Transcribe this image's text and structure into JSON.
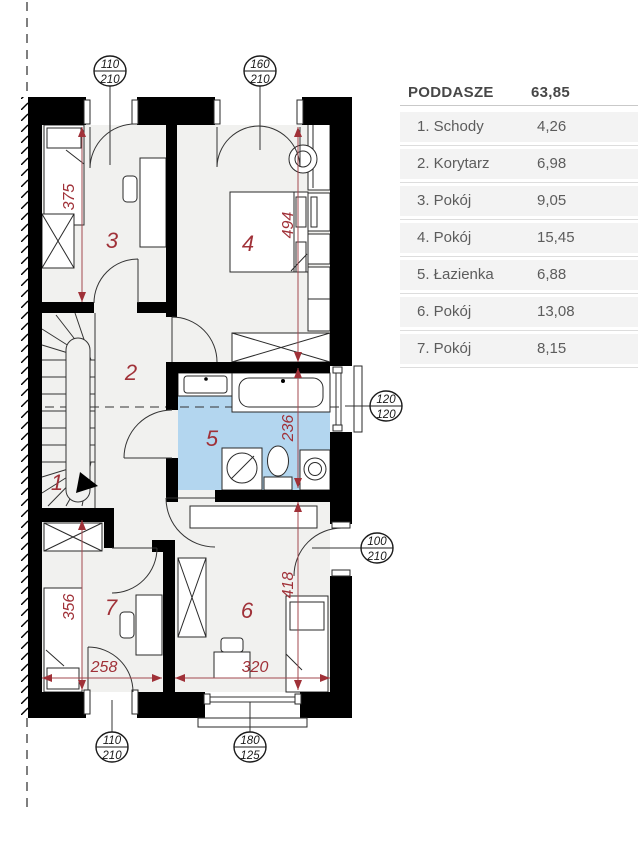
{
  "legend": {
    "title": "PODDASZE",
    "total_area": "63,85",
    "rows": [
      {
        "label": "1. Schody",
        "area": "4,26"
      },
      {
        "label": "2. Korytarz",
        "area": "6,98"
      },
      {
        "label": "3. Pokój",
        "area": "9,05"
      },
      {
        "label": "4. Pokój",
        "area": "15,45"
      },
      {
        "label": "5. Łazienka",
        "area": "6,88"
      },
      {
        "label": "6. Pokój",
        "area": "13,08"
      },
      {
        "label": "7. Pokój",
        "area": "8,15"
      }
    ]
  },
  "plan": {
    "room_labels": {
      "stairs": "1",
      "corridor": "2",
      "room3": "3",
      "room4": "4",
      "bathroom": "5",
      "room6": "6",
      "room7": "7"
    },
    "dimensions": {
      "room3_depth": "375",
      "room4_depth": "494",
      "bathroom_depth": "236",
      "room6_depth": "418",
      "room7_depth": "356",
      "room7_width": "258",
      "room6_width": "320"
    },
    "openings": {
      "top_left_window": {
        "width": "110",
        "height": "210"
      },
      "top_right_window": {
        "width": "160",
        "height": "210"
      },
      "bathroom_window": {
        "width": "120",
        "height": "120"
      },
      "room6_side_window": {
        "width": "100",
        "height": "210"
      },
      "bottom_left_window": {
        "width": "110",
        "height": "210"
      },
      "bottom_right_window": {
        "width": "180",
        "height": "125"
      }
    },
    "colors": {
      "bathroom_floor": "#b3d6ef",
      "dimension_red": "#a03138",
      "wall_black": "#000000",
      "room_floor": "#f1f1ef"
    }
  }
}
